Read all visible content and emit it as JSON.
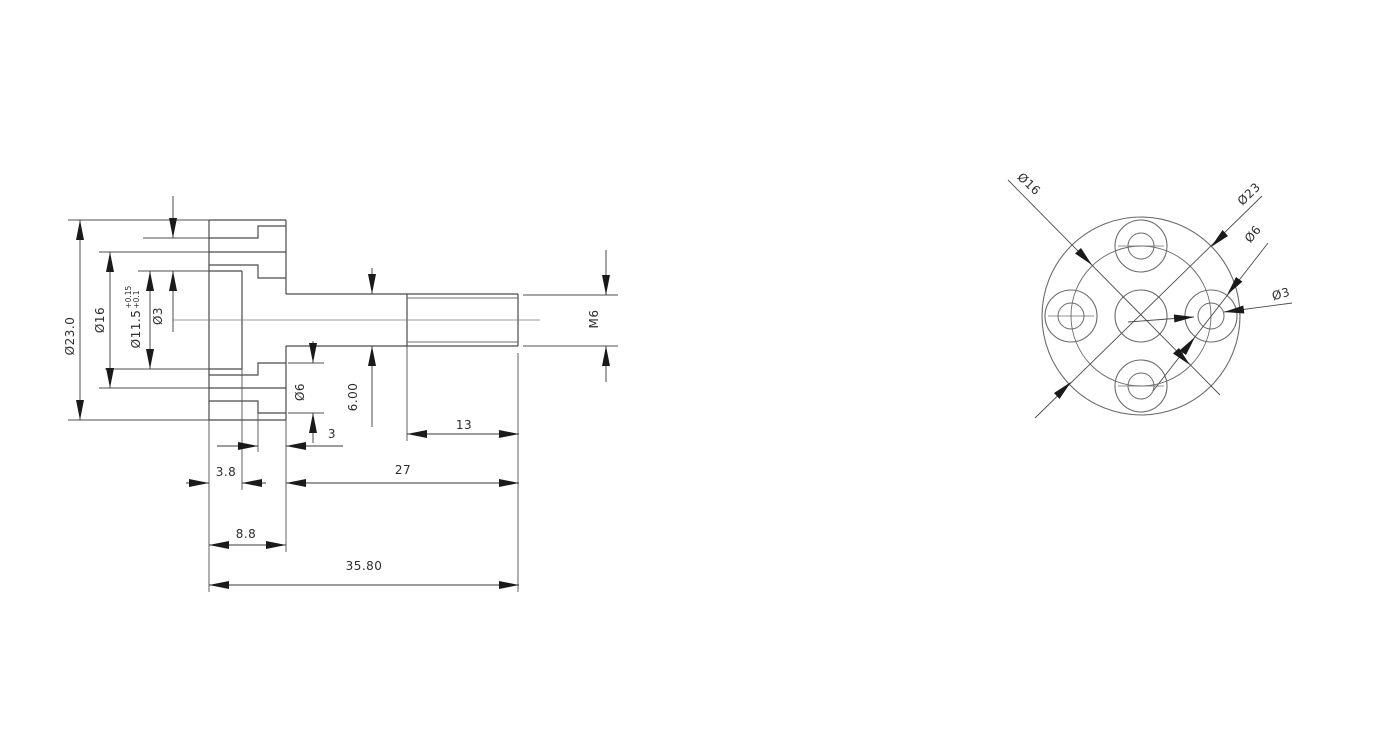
{
  "side_view": {
    "diameter_dims": {
      "flange_od": "Ø23.0",
      "bolt_circle": "Ø16",
      "bore": "Ø11.5",
      "bore_tol_upper": "+0.15",
      "bore_tol_lower": "+0.1",
      "hole": "Ø3",
      "boss": "Ø6",
      "shaft": "6.00",
      "thread": "M6"
    },
    "length_dims": {
      "groove_to_face": "3",
      "thread_length": "13",
      "recess_depth": "3.8",
      "shaft_length": "27",
      "flange_thickness": "8.8",
      "overall_length": "35.80"
    }
  },
  "front_view": {
    "labels": {
      "bolt_circle": "Ø16",
      "outer_diameter": "Ø23",
      "counterbore": "Ø6",
      "hole": "Ø3"
    }
  },
  "colors": {
    "background": "#ffffff",
    "outline": "#4a4a4a",
    "dimension": "#3a3a3a",
    "text": "#2e2e2e"
  }
}
